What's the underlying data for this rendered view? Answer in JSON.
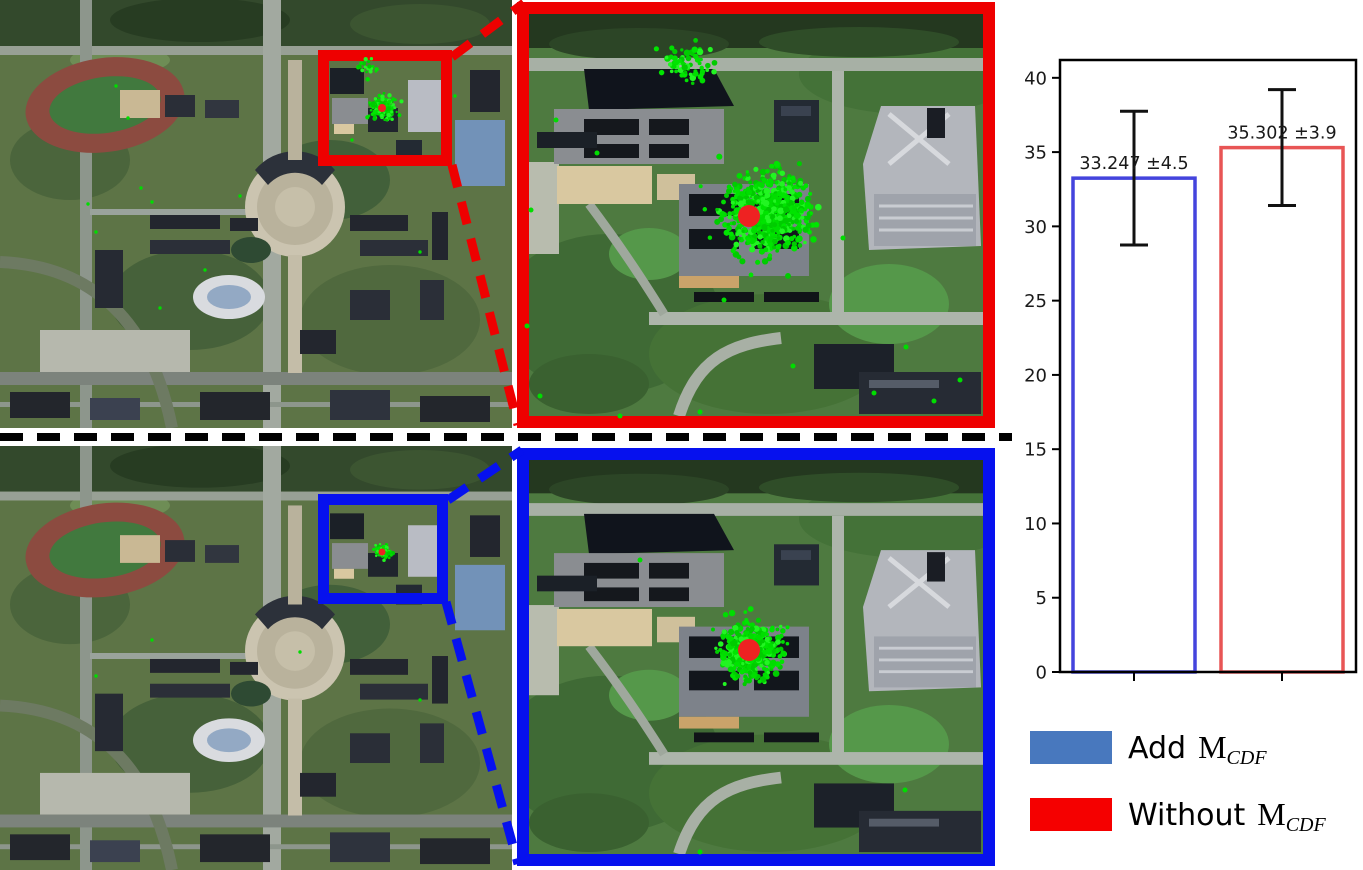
{
  "figure": {
    "kind": "paper-figure",
    "left_panels": {
      "map_top_name": "satellite map with red ROI box and green localization scatter",
      "map_bottom_name": "satellite map with blue ROI box and compact green localization scatter"
    },
    "middle_panels": {
      "zoom_top_name": "zoomed ROI crop, red border, wide green scatter around red ground-truth dot",
      "zoom_bottom_name": "zoomed ROI crop, blue border, tight green scatter around red ground-truth dot"
    },
    "divider_style": "black dashed horizontal line"
  },
  "colors": {
    "roi_top": "#ee0000",
    "roi_bottom": "#0611ee",
    "connector_red": "#ee0000",
    "connector_blue": "#0611ee",
    "bar_edge_blue": "#4444dd",
    "bar_edge_red": "#e85555",
    "legend_blue": "#4878be",
    "legend_red": "#f50000",
    "scatter_green": "#00dd00",
    "marker_red": "#ee2222",
    "error_bar": "#111111",
    "axis": "#000000",
    "tick_text": "#1a1a1a"
  },
  "chart_data": {
    "type": "bar",
    "title": "",
    "categories": [
      "Add M_CDF",
      "Without M_CDF"
    ],
    "values": [
      33.247,
      35.302
    ],
    "errors": [
      4.5,
      3.9
    ],
    "bar_labels": [
      "33.247 ±4.5",
      "35.302 ±3.9"
    ],
    "bar_edge_colors": [
      "#4444dd",
      "#e85555"
    ],
    "bar_fill": "none",
    "xlabel": "",
    "ylabel": "",
    "ylim": [
      0,
      41.2
    ],
    "yticks": [
      0,
      5,
      10,
      15,
      20,
      25,
      30,
      35,
      40
    ],
    "xtick_labels": [
      "",
      ""
    ],
    "grid": false,
    "legend_position": "below",
    "legend": [
      {
        "prefix": "Add",
        "symbol": "M",
        "subscript": "CDF",
        "color": "#4878be"
      },
      {
        "prefix": "Without",
        "symbol": "M",
        "subscript": "CDF",
        "color": "#f50000"
      }
    ]
  },
  "overlays": [
    {
      "panel": "map-top",
      "seed": 11,
      "dot_r": 1.7,
      "clusters": [
        {
          "cx": 383,
          "cy": 108,
          "sigma": 6,
          "n": 150,
          "rmax": 15
        },
        {
          "cx": 383,
          "cy": 108,
          "sigma": 10,
          "n": 26,
          "rmax": 20
        },
        {
          "cx": 367,
          "cy": 67,
          "sigma": 6,
          "n": 24,
          "rmax": 13
        }
      ],
      "strays": [
        [
          116,
          86
        ],
        [
          141,
          188
        ],
        [
          152,
          202
        ],
        [
          96,
          232
        ],
        [
          205,
          270
        ],
        [
          160,
          308
        ],
        [
          352,
          140
        ],
        [
          420,
          252
        ],
        [
          455,
          96
        ],
        [
          128,
          118
        ],
        [
          240,
          196
        ],
        [
          88,
          204
        ]
      ],
      "red_dot": {
        "cx": 382,
        "cy": 108,
        "r": 4
      }
    },
    {
      "panel": "map-bottom",
      "seed": 22,
      "dot_r": 1.7,
      "clusters": [
        {
          "cx": 383,
          "cy": 552,
          "sigma": 4,
          "n": 70,
          "rmax": 10
        }
      ],
      "strays": [
        [
          300,
          652
        ],
        [
          96,
          676
        ],
        [
          152,
          640
        ],
        [
          420,
          700
        ]
      ],
      "red_dot": {
        "cx": 382,
        "cy": 552,
        "r": 3.5
      }
    },
    {
      "panel": "zoom-top",
      "seed": 33,
      "dot_r": 2.5,
      "clusters": [
        {
          "cx": 766,
          "cy": 214,
          "sigma": 20,
          "n": 650,
          "rmax": 52
        },
        {
          "cx": 766,
          "cy": 214,
          "sigma": 33,
          "n": 70,
          "rmax": 76
        },
        {
          "cx": 687,
          "cy": 62,
          "sigma": 13,
          "n": 70,
          "rmax": 34
        }
      ],
      "strays": [
        [
          531,
          210
        ],
        [
          597,
          153
        ],
        [
          540,
          396
        ],
        [
          700,
          412
        ],
        [
          793,
          366
        ],
        [
          906,
          347
        ],
        [
          874,
          393
        ],
        [
          934,
          401
        ],
        [
          843,
          238
        ],
        [
          556,
          120
        ],
        [
          527,
          326
        ],
        [
          960,
          380
        ],
        [
          620,
          416
        ],
        [
          724,
          300
        ]
      ],
      "red_dot": {
        "cx": 749,
        "cy": 216,
        "r": 11
      }
    },
    {
      "panel": "zoom-bottom",
      "seed": 44,
      "dot_r": 2.5,
      "clusters": [
        {
          "cx": 750,
          "cy": 650,
          "sigma": 14,
          "n": 420,
          "rmax": 36
        },
        {
          "cx": 750,
          "cy": 650,
          "sigma": 23,
          "n": 46,
          "rmax": 54
        }
      ],
      "strays": [
        [
          700,
          852
        ],
        [
          640,
          560
        ],
        [
          905,
          790
        ]
      ],
      "red_dot": {
        "cx": 749,
        "cy": 650,
        "r": 11
      }
    }
  ]
}
